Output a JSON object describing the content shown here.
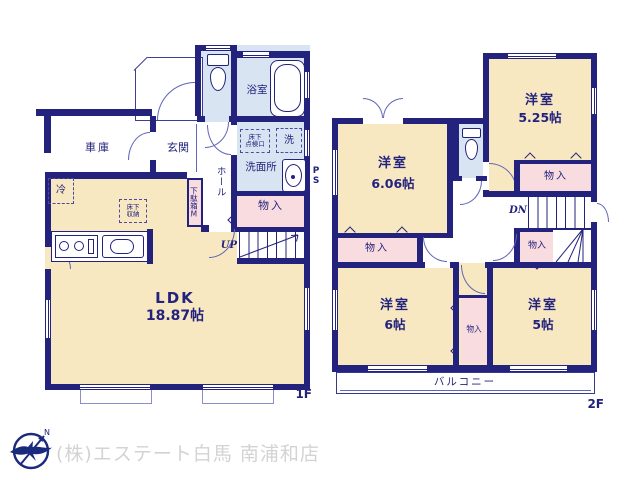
{
  "colors": {
    "wall": "#23237d",
    "room_cream": "#f8e8c2",
    "wet_blue": "#d8e4f2",
    "closet_pink": "#f9dce0",
    "logo_navy": "#1c2a7e",
    "footer_gray": "#d3d3d3"
  },
  "floor1": {
    "label": "1F",
    "garage": "車庫",
    "entrance": "玄関",
    "bath": "浴室",
    "washroom": "洗面所",
    "laundry": "洗",
    "hatch_line1": "床下",
    "hatch_line2": "点検口",
    "hall": "ホール",
    "shoe_cabinet": "下駄箱M",
    "closet": "物入",
    "up": "UP",
    "ps": "PS",
    "fridge": "冷",
    "storage_line1": "床下",
    "storage_line2": "収納",
    "ldk": "LDK",
    "ldk_size": "18.87帖"
  },
  "floor2": {
    "label": "2F",
    "room_a": "洋室",
    "room_a_size": "5.25帖",
    "room_b": "洋室",
    "room_b_size": "6.06帖",
    "room_c": "洋室",
    "room_c_size": "6帖",
    "room_d": "洋室",
    "room_d_size": "5帖",
    "closet_a": "物入",
    "closet_b": "物入",
    "closet_c": "物入",
    "closet_d": "物入",
    "dn": "DN",
    "balcony": "バルコニー"
  },
  "footer": {
    "company": "(株)エステート白馬 南浦和店",
    "compass_n": "N"
  }
}
